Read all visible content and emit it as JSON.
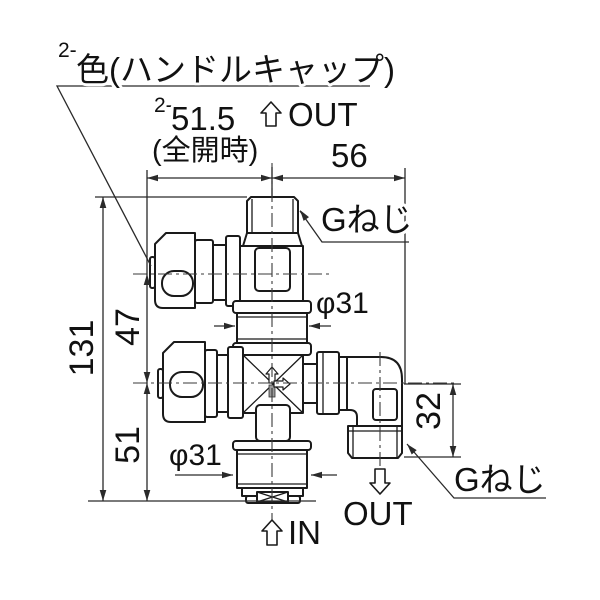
{
  "figure": {
    "type": "technical-drawing",
    "subject": "dual-outlet stop valve with two handles, top G-thread outlet, side elbow G-thread outlet and bottom inlet",
    "background": "#ffffff",
    "line_color": "#1a1a1a",
    "dim_color": "#2a2a2a",
    "stem_fill": "#9a9a9a"
  },
  "note": {
    "prefix": "2-",
    "text": "色(ハンドルキャップ)"
  },
  "dimensions": {
    "open_width": {
      "prefix": "2-",
      "value": "51.5",
      "qualifier": "(全開時)"
    },
    "right_width": "56",
    "total_height": "131",
    "upper_span": "47",
    "lower_span": "51",
    "elbow_drop": "32",
    "upper_diameter": "φ31",
    "lower_diameter": "φ31"
  },
  "labels": {
    "thread_top": "Gねじ",
    "thread_side": "Gねじ"
  },
  "flow": {
    "out_top": "OUT",
    "out_side": "OUT",
    "in_bottom": "IN"
  }
}
